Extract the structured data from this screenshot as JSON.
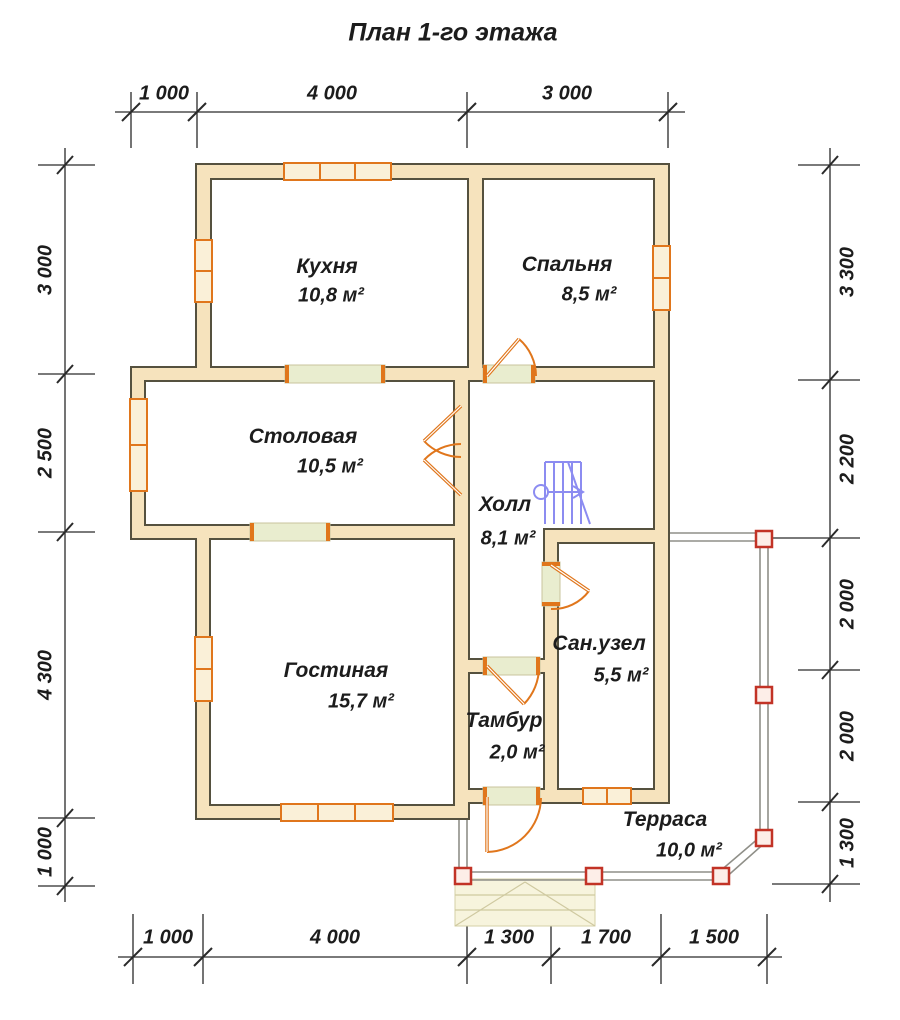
{
  "title": "План 1-го этажа",
  "rooms": {
    "kitchen": {
      "name": "Кухня",
      "area": "10,8 м²"
    },
    "bedroom": {
      "name": "Спальня",
      "area": "8,5 м²"
    },
    "dining": {
      "name": "Столовая",
      "area": "10,5 м²"
    },
    "hall": {
      "name": "Холл",
      "area": "8,1 м²"
    },
    "living": {
      "name": "Гостиная",
      "area": "15,7 м²"
    },
    "bathroom": {
      "name": "Сан.узел",
      "area": "5,5 м²"
    },
    "vestibule": {
      "name": "Тамбур",
      "area": "2,0 м²"
    },
    "terrace": {
      "name": "Терраса",
      "area": "10,0 м²"
    }
  },
  "dimensions": {
    "top": [
      "1 000",
      "4 000",
      "3 000"
    ],
    "bottom": [
      "1 000",
      "4 000",
      "1 300",
      "1 700",
      "1 500"
    ],
    "left": [
      "3 000",
      "2 500",
      "4 300",
      "1 000"
    ],
    "right": [
      "3 300",
      "2 200",
      "2 000",
      "2 000",
      "1 300"
    ]
  },
  "colors": {
    "wall_fill": "#f6e3bd",
    "wall_outline": "#55513f",
    "window_frame": "#e0761c",
    "opening_sill": "#e9edcf",
    "stairs": "#8080f0",
    "terrace_outline": "#8f8f88",
    "post_red": "#c23326",
    "dimension": "#2a2a2a"
  }
}
